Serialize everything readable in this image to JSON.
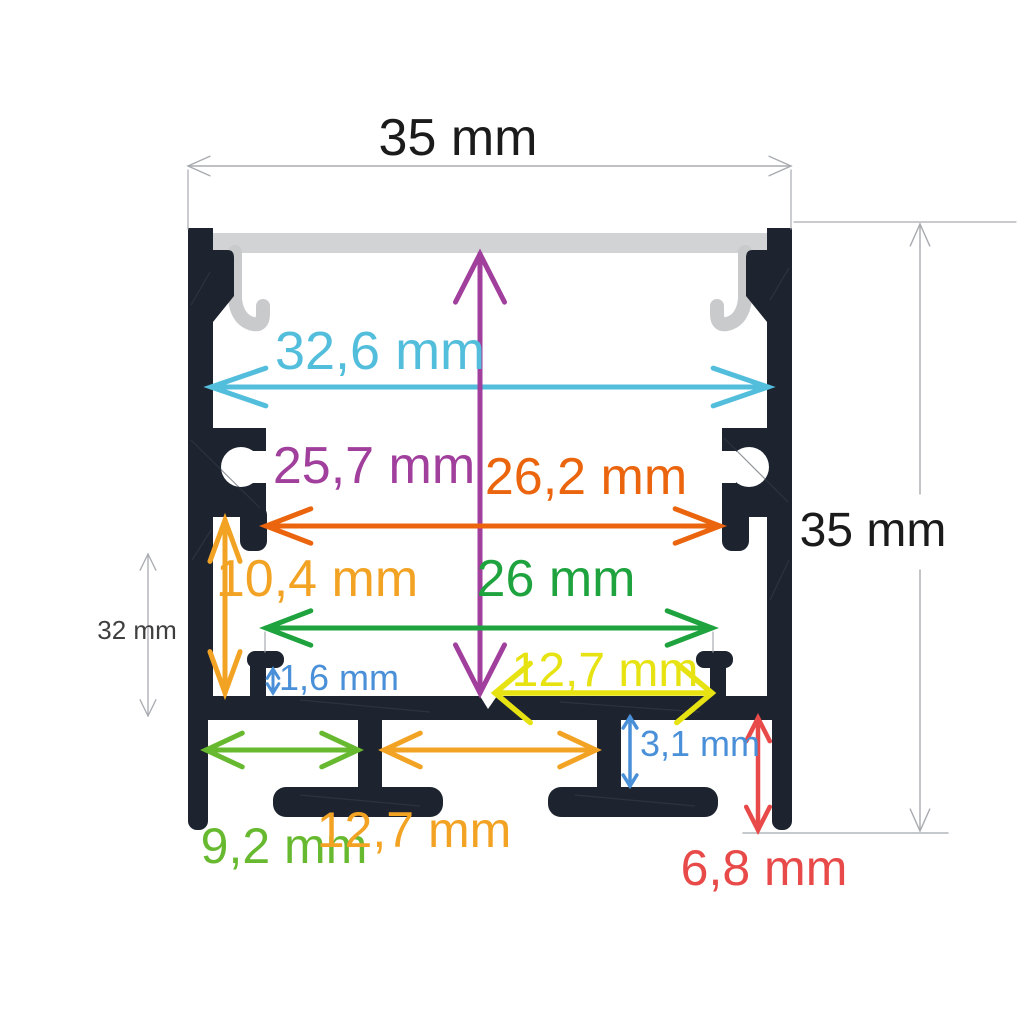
{
  "dimensions": {
    "top_width": {
      "label": "35 mm",
      "color": "#1b1b1b"
    },
    "overall_height": {
      "label": "35 mm",
      "color": "#1b1b1b"
    },
    "inner_top_width": {
      "label": "32,6 mm",
      "color": "#53bedc"
    },
    "inner_height": {
      "label": "25,7 mm",
      "color": "#a13f9d"
    },
    "mount_slot_span": {
      "label": "26,2 mm",
      "color": "#ea650e"
    },
    "lower_cavity_height": {
      "label": "10,4 mm",
      "color": "#f3a324"
    },
    "base_inner_width": {
      "label": "26 mm",
      "color": "#1ea33e"
    },
    "ridge_height": {
      "label": "1,6 mm",
      "color": "#4a90d8"
    },
    "seat_width": {
      "label": "12,7 mm",
      "color": "#e7e312"
    },
    "left_channel_width": {
      "label": "9,2 mm",
      "color": "#67ba2f"
    },
    "center_channel_width": {
      "label": "12,7 mm",
      "color": "#f3a324"
    },
    "foot_gap_height": {
      "label": "3,1 mm",
      "color": "#4a90d8"
    },
    "foot_height": {
      "label": "6,8 mm",
      "color": "#e84a49"
    },
    "side_reference_height": {
      "label": "32 mm",
      "color": "#3f3f3f"
    }
  },
  "palette": {
    "profile_body": "#1d242f",
    "profile_texture": "#39414d",
    "diffuser": "#d2d3d5",
    "diffuser_clip": "#c9cacc",
    "dim_line": "#a8abb0",
    "ground_line": "#b4b7ba",
    "background": "#ffffff"
  }
}
